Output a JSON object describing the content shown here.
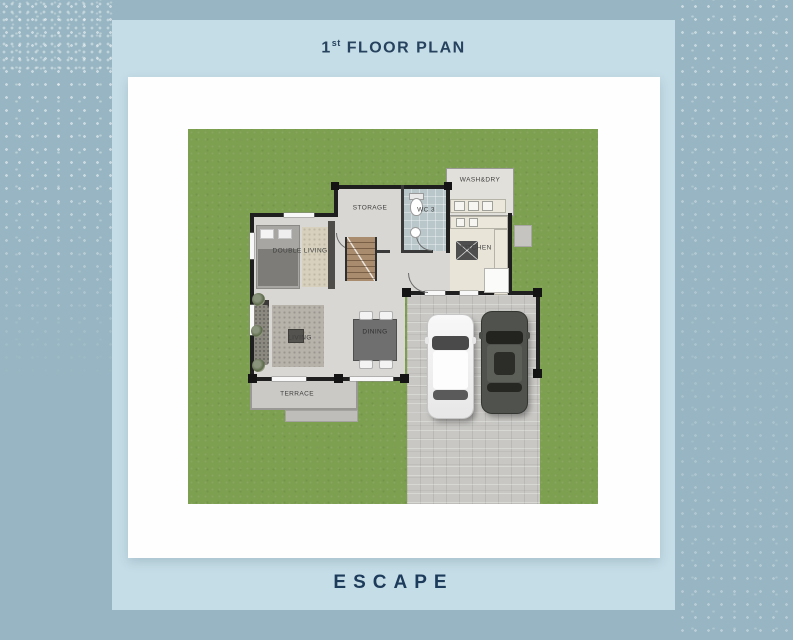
{
  "header": {
    "title_number": "1",
    "title_ordinal": "st",
    "title_text": "FLOOR PLAN"
  },
  "footer": {
    "brand": "ESCAPE"
  },
  "floor_plan": {
    "rooms": {
      "double_living": "DOUBLE LIVING",
      "storage": "STORAGE",
      "wc3": "WC 3",
      "wash_dry": "WASH&DRY",
      "kitchen": "KITCHEN",
      "living": "LIVING",
      "dining": "DINING",
      "terrace": "TERRACE"
    },
    "vehicles": [
      "white-car",
      "dark-car"
    ]
  },
  "colors": {
    "background": "#97b5c2",
    "panel": "#c5dde7",
    "card": "#fefefe",
    "title_navy": "#27425e",
    "grass": "#7d9f50",
    "floor": "#d9d7d3",
    "wall": "#1f1f1f",
    "driveway": "#c8c7c4",
    "wc_tile": "#b9c7cb",
    "stair_wood": "#a98c6d"
  }
}
